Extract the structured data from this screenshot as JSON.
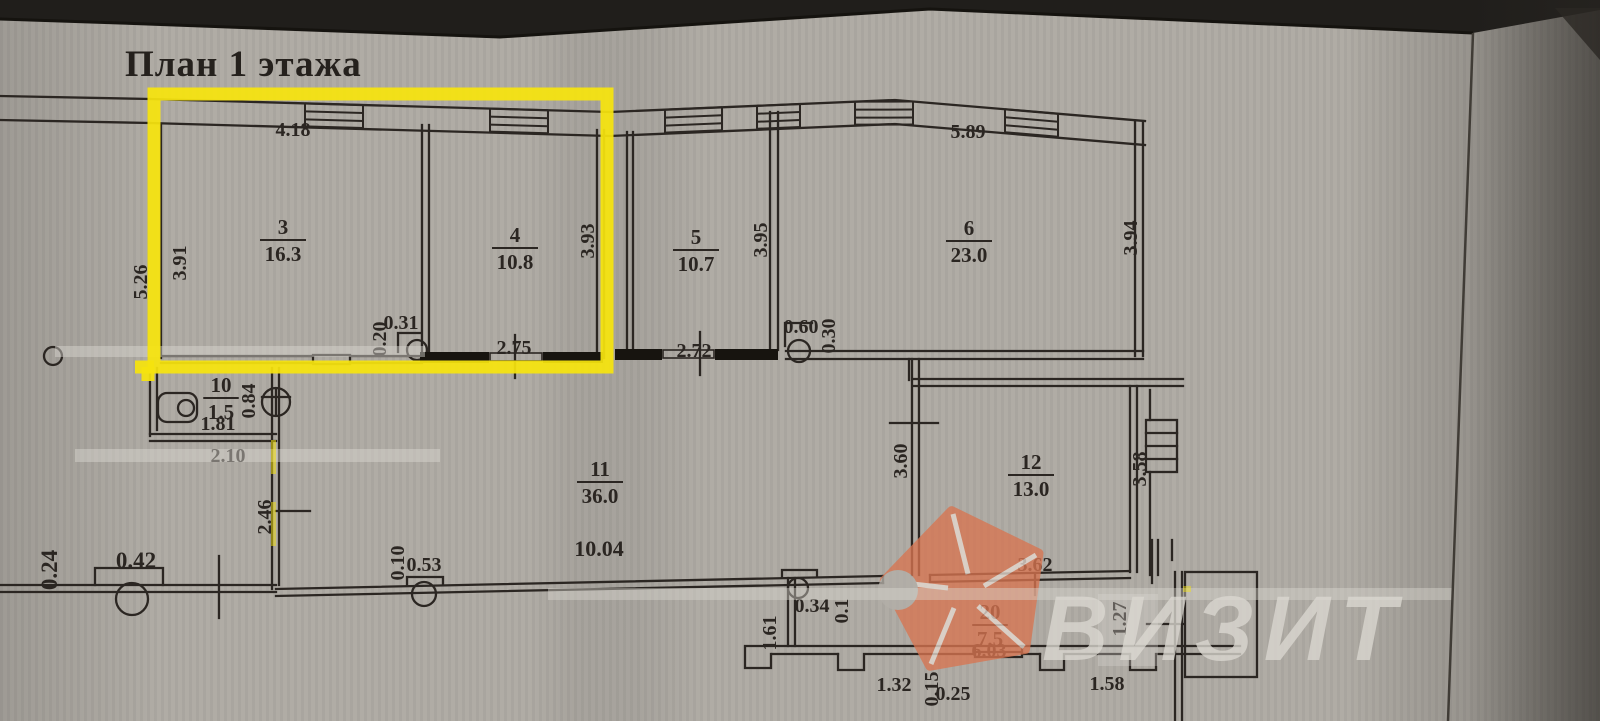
{
  "title": "План 1 этажа",
  "watermark": {
    "text": "ВИЗИТ",
    "logo_color": "#d87551",
    "text_color": "#dbd8d1"
  },
  "colors": {
    "paper": "#aeaaa3",
    "ink": "#2b2622",
    "wall_dark": "#17140f",
    "highlight": "#f6e40e"
  },
  "rooms": [
    {
      "num": "3",
      "area": "16.3",
      "cx": 283,
      "cy": 234
    },
    {
      "num": "4",
      "area": "10.8",
      "cx": 515,
      "cy": 242
    },
    {
      "num": "5",
      "area": "10.7",
      "cx": 696,
      "cy": 244
    },
    {
      "num": "6",
      "area": "23.0",
      "cx": 969,
      "cy": 235
    },
    {
      "num": "10",
      "area": "1.5",
      "cx": 221,
      "cy": 392
    },
    {
      "num": "11",
      "area": "36.0",
      "cx": 600,
      "cy": 476
    },
    {
      "num": "12",
      "area": "13.0",
      "cx": 1031,
      "cy": 469
    },
    {
      "num": "20",
      "area": "7.5",
      "cx": 990,
      "cy": 619
    }
  ],
  "dims": [
    {
      "t": "4.18",
      "x": 293,
      "y": 129
    },
    {
      "t": "3.91",
      "x": 179,
      "y": 263,
      "v": true
    },
    {
      "t": "5.26",
      "x": 140,
      "y": 282,
      "v": true
    },
    {
      "t": "0.20",
      "x": 379,
      "y": 339,
      "v": true
    },
    {
      "t": "0.31",
      "x": 401,
      "y": 322
    },
    {
      "t": "2.75",
      "x": 514,
      "y": 347
    },
    {
      "t": "3.93",
      "x": 587,
      "y": 241,
      "v": true
    },
    {
      "t": "2.72",
      "x": 694,
      "y": 350
    },
    {
      "t": "3.95",
      "x": 760,
      "y": 240,
      "v": true
    },
    {
      "t": "0.60",
      "x": 801,
      "y": 326
    },
    {
      "t": "0.30",
      "x": 828,
      "y": 336,
      "v": true
    },
    {
      "t": "5.89",
      "x": 968,
      "y": 131
    },
    {
      "t": "3.94",
      "x": 1130,
      "y": 238,
      "v": true
    },
    {
      "t": "1.81",
      "x": 218,
      "y": 423
    },
    {
      "t": "0.84",
      "x": 248,
      "y": 401,
      "v": true
    },
    {
      "t": "2.10",
      "x": 228,
      "y": 455
    },
    {
      "t": "2.46",
      "x": 264,
      "y": 517,
      "v": true
    },
    {
      "t": "0.24",
      "x": 50,
      "y": 570,
      "v": true,
      "fs": 23
    },
    {
      "t": "0.42",
      "x": 136,
      "y": 561,
      "fs": 23
    },
    {
      "t": "0.10",
      "x": 397,
      "y": 563,
      "v": true
    },
    {
      "t": "0.53",
      "x": 424,
      "y": 564
    },
    {
      "t": "10.04",
      "x": 599,
      "y": 549,
      "fs": 22
    },
    {
      "t": "3.60",
      "x": 900,
      "y": 461,
      "v": true
    },
    {
      "t": "3.58",
      "x": 1139,
      "y": 469,
      "v": true
    },
    {
      "t": "3.62",
      "x": 1035,
      "y": 564
    },
    {
      "t": "0.34",
      "x": 812,
      "y": 605
    },
    {
      "t": "0.1",
      "x": 841,
      "y": 611,
      "v": true
    },
    {
      "t": "1.61",
      "x": 769,
      "y": 633,
      "v": true
    },
    {
      "t": "6.03",
      "x": 989,
      "y": 650
    },
    {
      "t": "1.32",
      "x": 894,
      "y": 684
    },
    {
      "t": "0.15",
      "x": 931,
      "y": 689,
      "v": true
    },
    {
      "t": "0.25",
      "x": 953,
      "y": 693
    },
    {
      "t": "1.58",
      "x": 1107,
      "y": 683
    },
    {
      "t": "1.27",
      "x": 1119,
      "y": 619,
      "v": true
    },
    {
      "t": "6.45",
      "x": 941,
      "y": 728
    }
  ]
}
